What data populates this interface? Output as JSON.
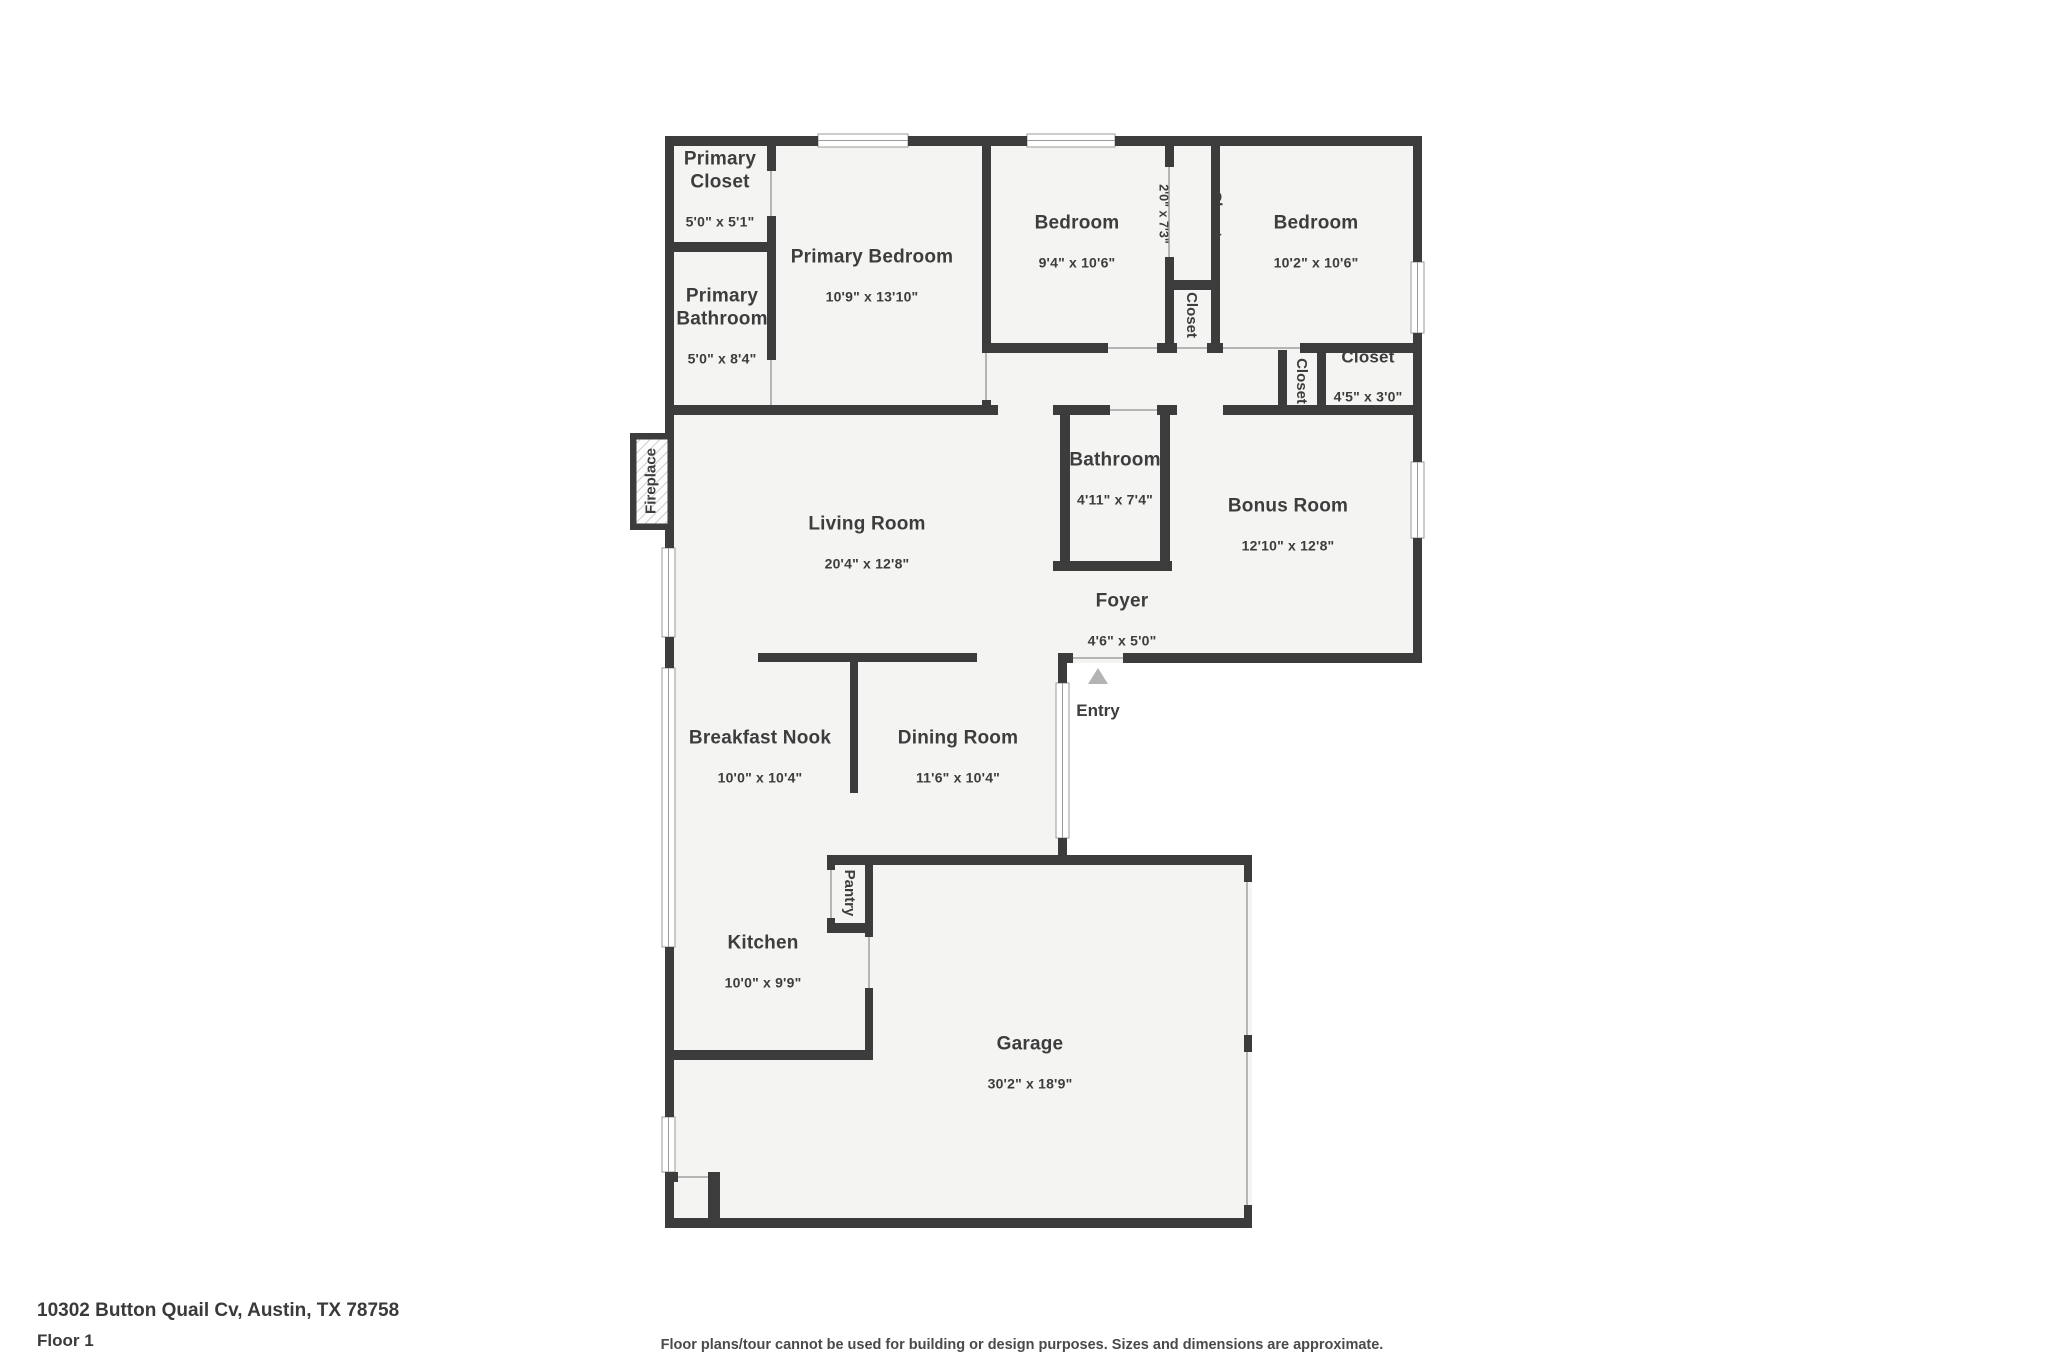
{
  "plan": {
    "rooms": [
      {
        "name": "Primary\nCloset",
        "dims": "5'0\" x 5'1\""
      },
      {
        "name": "Primary Bedroom",
        "dims": "10'9\" x 13'10\""
      },
      {
        "name": "Primary\nBathroom",
        "dims": "5'0\" x 8'4\""
      },
      {
        "name": "Bedroom",
        "dims": "9'4\" x 10'6\""
      },
      {
        "name": "Closet",
        "dims": "2'0\" x 7'3\""
      },
      {
        "name": "Bedroom",
        "dims": "10'2\" x 10'6\""
      },
      {
        "name": "Closet",
        "dims": ""
      },
      {
        "name": "Closet",
        "dims": ""
      },
      {
        "name": "Closet",
        "dims": "4'5\" x 3'0\""
      },
      {
        "name": "Bathroom",
        "dims": "4'11\" x 7'4\""
      },
      {
        "name": "Bonus Room",
        "dims": "12'10\" x 12'8\""
      },
      {
        "name": "Foyer",
        "dims": "4'6\" x 5'0\""
      },
      {
        "name": "Living Room",
        "dims": "20'4\" x 12'8\""
      },
      {
        "name": "Breakfast Nook",
        "dims": "10'0\" x 10'4\""
      },
      {
        "name": "Dining Room",
        "dims": "11'6\" x 10'4\""
      },
      {
        "name": "Pantry",
        "dims": ""
      },
      {
        "name": "Kitchen",
        "dims": "10'0\" x 9'9\""
      },
      {
        "name": "Garage",
        "dims": "30'2\" x 18'9\""
      },
      {
        "name": "Fireplace",
        "dims": ""
      },
      {
        "name": "Entry",
        "dims": ""
      }
    ],
    "colors": {
      "wall": "#3c3c3c",
      "floor": "#f4f4f2",
      "window_line": "#9a9a9a",
      "door_line": "#b5b5b5",
      "text": "#3d3d3d",
      "entry_arrow": "#b3b3b3"
    }
  },
  "footer": {
    "address": "10302 Button Quail Cv, Austin, TX 78758",
    "floor": "Floor 1",
    "disclaimer": "Floor plans/tour cannot be used for building or design purposes. Sizes and dimensions are approximate."
  }
}
